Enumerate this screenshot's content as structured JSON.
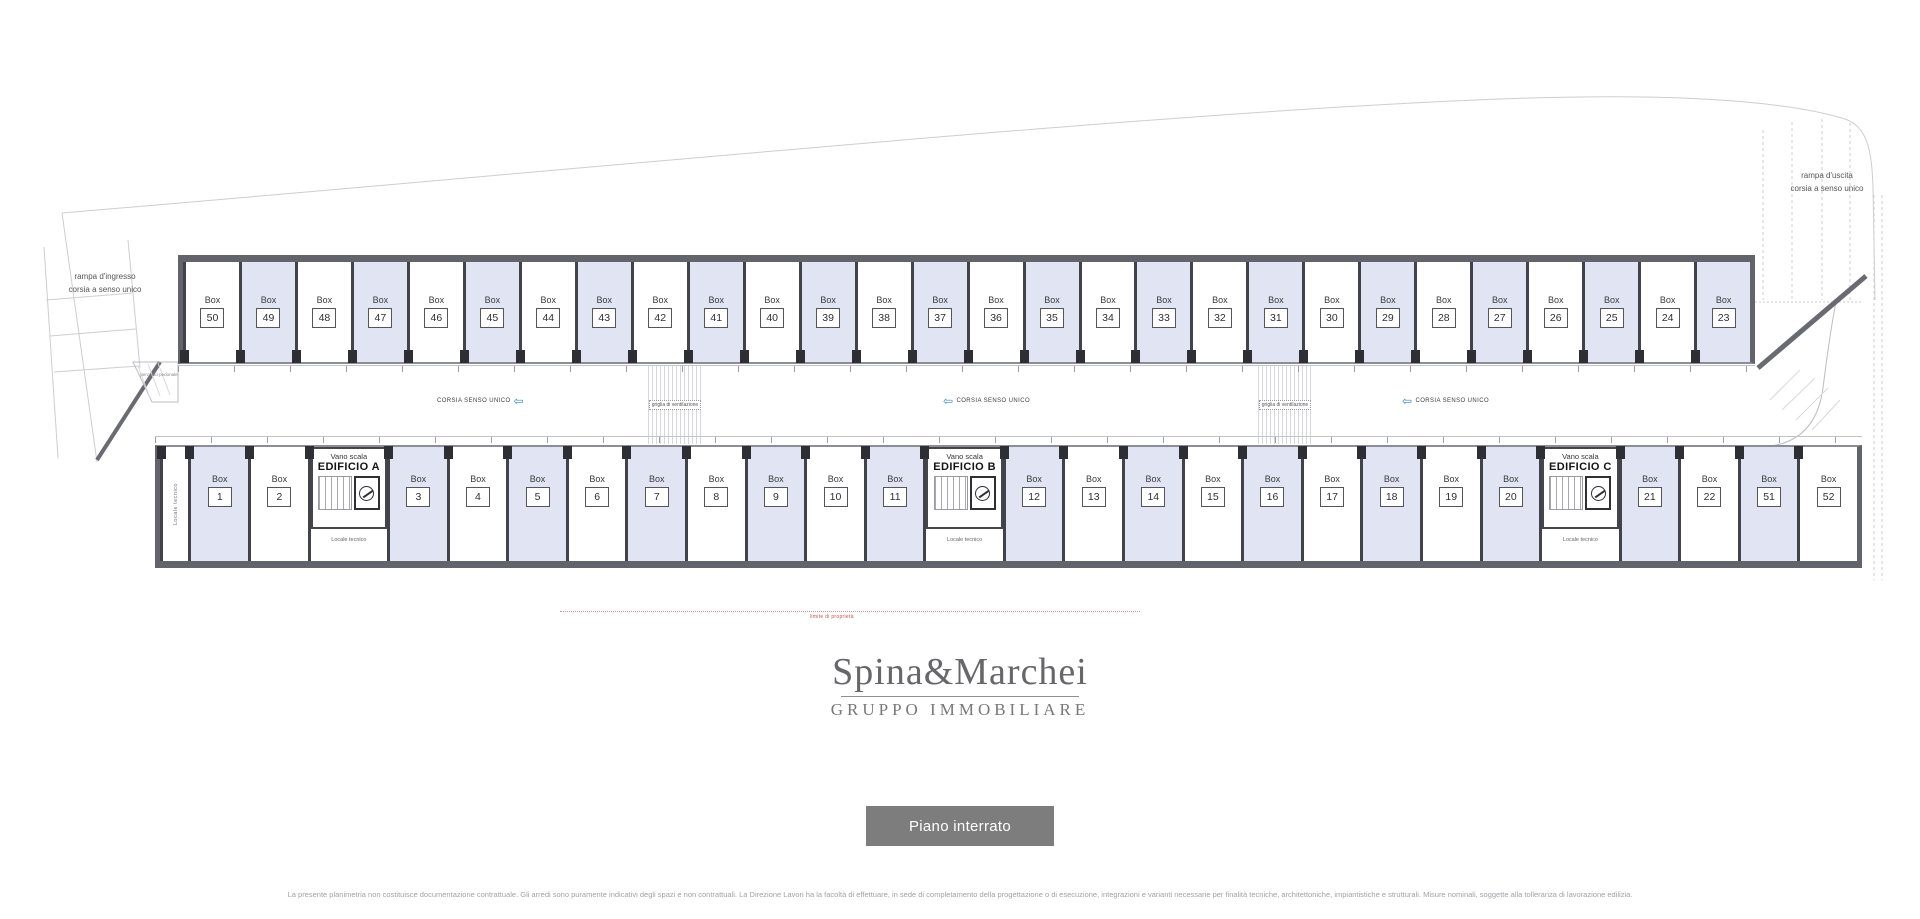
{
  "plan": {
    "labels": {
      "box_word": "Box",
      "entrance_ramp_line1": "rampa d'ingresso",
      "entrance_ramp_line2": "corsia a senso unico",
      "exit_ramp_line1": "rampa d'uscita",
      "exit_ramp_line2": "corsia a senso unico",
      "one_way_lane": "CORSIA SENSO UNICO",
      "ventilation_grid": "griglia di ventilazione",
      "stairwell": "Vano scala",
      "technical_room": "Locale tecnico",
      "pedestrian_path": "percorso pedonale",
      "property_line": "limite di proprietà"
    },
    "colors": {
      "shaded_box": "#e1e4f3",
      "wall": "#63636b",
      "lane_arrow_blue": "#3d85c0",
      "property_line_red": "#c0544e"
    },
    "top_row_boxes": [
      {
        "num": "50",
        "shaded": false
      },
      {
        "num": "49",
        "shaded": true
      },
      {
        "num": "48",
        "shaded": false
      },
      {
        "num": "47",
        "shaded": true
      },
      {
        "num": "46",
        "shaded": false
      },
      {
        "num": "45",
        "shaded": true
      },
      {
        "num": "44",
        "shaded": false
      },
      {
        "num": "43",
        "shaded": true
      },
      {
        "num": "42",
        "shaded": false
      },
      {
        "num": "41",
        "shaded": true
      },
      {
        "num": "40",
        "shaded": false
      },
      {
        "num": "39",
        "shaded": true
      },
      {
        "num": "38",
        "shaded": false
      },
      {
        "num": "37",
        "shaded": true
      },
      {
        "num": "36",
        "shaded": false
      },
      {
        "num": "35",
        "shaded": true
      },
      {
        "num": "34",
        "shaded": false
      },
      {
        "num": "33",
        "shaded": true
      },
      {
        "num": "32",
        "shaded": false
      },
      {
        "num": "31",
        "shaded": true
      },
      {
        "num": "30",
        "shaded": false
      },
      {
        "num": "29",
        "shaded": true
      },
      {
        "num": "28",
        "shaded": false
      },
      {
        "num": "27",
        "shaded": true
      },
      {
        "num": "26",
        "shaded": false
      },
      {
        "num": "25",
        "shaded": true
      },
      {
        "num": "24",
        "shaded": false
      },
      {
        "num": "23",
        "shaded": true
      }
    ],
    "bottom_row_cells": [
      {
        "type": "tech"
      },
      {
        "type": "box",
        "num": "1",
        "shaded": true
      },
      {
        "type": "box",
        "num": "2",
        "shaded": false
      },
      {
        "type": "stair",
        "name": "EDIFICIO A"
      },
      {
        "type": "box",
        "num": "3",
        "shaded": true
      },
      {
        "type": "box",
        "num": "4",
        "shaded": false
      },
      {
        "type": "box",
        "num": "5",
        "shaded": true
      },
      {
        "type": "box",
        "num": "6",
        "shaded": false
      },
      {
        "type": "box",
        "num": "7",
        "shaded": true
      },
      {
        "type": "box",
        "num": "8",
        "shaded": false
      },
      {
        "type": "box",
        "num": "9",
        "shaded": true
      },
      {
        "type": "box",
        "num": "10",
        "shaded": false
      },
      {
        "type": "box",
        "num": "11",
        "shaded": true
      },
      {
        "type": "stair",
        "name": "EDIFICIO B"
      },
      {
        "type": "box",
        "num": "12",
        "shaded": true
      },
      {
        "type": "box",
        "num": "13",
        "shaded": false
      },
      {
        "type": "box",
        "num": "14",
        "shaded": true
      },
      {
        "type": "box",
        "num": "15",
        "shaded": false
      },
      {
        "type": "box",
        "num": "16",
        "shaded": true
      },
      {
        "type": "box",
        "num": "17",
        "shaded": false
      },
      {
        "type": "box",
        "num": "18",
        "shaded": true
      },
      {
        "type": "box",
        "num": "19",
        "shaded": false
      },
      {
        "type": "box",
        "num": "20",
        "shaded": true
      },
      {
        "type": "stair",
        "name": "EDIFICIO C"
      },
      {
        "type": "box",
        "num": "21",
        "shaded": true
      },
      {
        "type": "box",
        "num": "22",
        "shaded": false
      },
      {
        "type": "box",
        "num": "51",
        "shaded": true
      },
      {
        "type": "box",
        "num": "52",
        "shaded": false
      }
    ]
  },
  "brand": {
    "name": "Spina&Marchei",
    "tagline": "GRUPPO IMMOBILIARE"
  },
  "floor_button": {
    "label": "Piano interrato"
  },
  "disclaimer": "La presente planimetria non costituisce documentazione contrattuale. Gli arredi sono puramente indicativi degli spazi e non contrattuali. La Direzione Lavori ha la facoltà di effettuare, in sede di completamento della progettazione o di esecuzione, integrazioni e varianti necessarie per finalità tecniche, architettoniche, impiantistiche e strutturali. Misure nominali, soggette alla tolleranza di lavorazione edilizia."
}
